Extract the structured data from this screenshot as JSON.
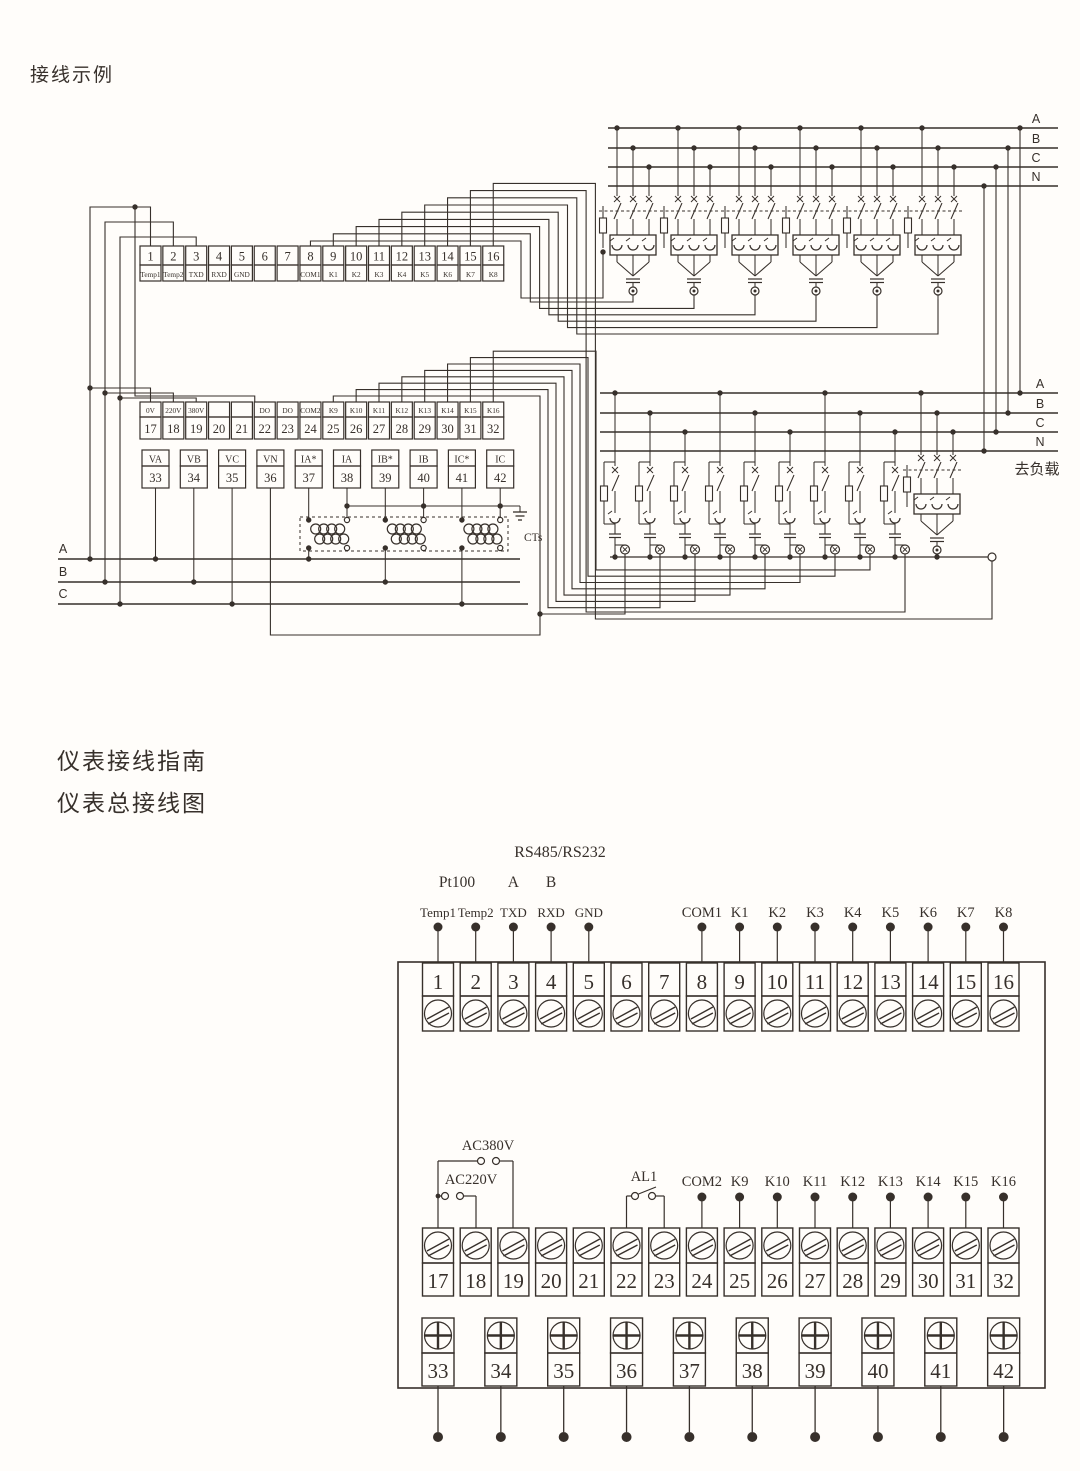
{
  "page": {
    "ink": "#37302b",
    "bg": "#fffdfa"
  },
  "titles": {
    "example": "接线示例",
    "guide": "仪表接线指南",
    "overall": "仪表总接线图"
  },
  "example": {
    "row1_numbers": [
      "1",
      "2",
      "3",
      "4",
      "5",
      "6",
      "7",
      "8",
      "9",
      "10",
      "11",
      "12",
      "13",
      "14",
      "15",
      "16"
    ],
    "row1_labels": [
      "Temp1",
      "Temp2",
      "TXD",
      "RXD",
      "GND",
      "",
      "",
      "COM1",
      "K1",
      "K2",
      "K3",
      "K4",
      "K5",
      "K6",
      "K7",
      "K8"
    ],
    "row2_labels": [
      "0V",
      "220V",
      "380V",
      "",
      "",
      "DO",
      "DO",
      "COM2",
      "K9",
      "K10",
      "K11",
      "K12",
      "K13",
      "K14",
      "K15",
      "K16"
    ],
    "row2_numbers": [
      "17",
      "18",
      "19",
      "20",
      "21",
      "22",
      "23",
      "24",
      "25",
      "26",
      "27",
      "28",
      "29",
      "30",
      "31",
      "32"
    ],
    "row3_labels": [
      "VA",
      "VB",
      "VC",
      "VN",
      "IA*",
      "IA",
      "IB*",
      "IB",
      "IC*",
      "IC"
    ],
    "row3_numbers": [
      "33",
      "34",
      "35",
      "36",
      "37",
      "38",
      "39",
      "40",
      "41",
      "42"
    ],
    "bus_top": [
      "A",
      "B",
      "C",
      "N"
    ],
    "bus_mid": [
      "A",
      "B",
      "C",
      "N"
    ],
    "bus_left": [
      "A",
      "B",
      "C"
    ],
    "to_load": "去负载",
    "cts": "CTs"
  },
  "terminal": {
    "rs": "RS485/RS232",
    "pt100": "Pt100",
    "rs_a": "A",
    "rs_b": "B",
    "top_labels": [
      "Temp1",
      "Temp2",
      "TXD",
      "RXD",
      "GND"
    ],
    "com_k": [
      "COM1",
      "K1",
      "K2",
      "K3",
      "K4",
      "K5",
      "K6",
      "K7",
      "K8"
    ],
    "strip1": [
      "1",
      "2",
      "3",
      "4",
      "5",
      "6",
      "7",
      "8",
      "9",
      "10",
      "11",
      "12",
      "13",
      "14",
      "15",
      "16"
    ],
    "ac380": "AC380V",
    "ac220": "AC220V",
    "al1": "AL1",
    "mid_labels": [
      "COM2",
      "K9",
      "K10",
      "K11",
      "K12",
      "K13",
      "K14",
      "K15",
      "K16"
    ],
    "strip2": [
      "17",
      "18",
      "19",
      "20",
      "21",
      "22",
      "23",
      "24",
      "25",
      "26",
      "27",
      "28",
      "29",
      "30",
      "31",
      "32"
    ],
    "strip3": [
      "33",
      "34",
      "35",
      "36",
      "37",
      "38",
      "39",
      "40",
      "41",
      "42"
    ]
  }
}
